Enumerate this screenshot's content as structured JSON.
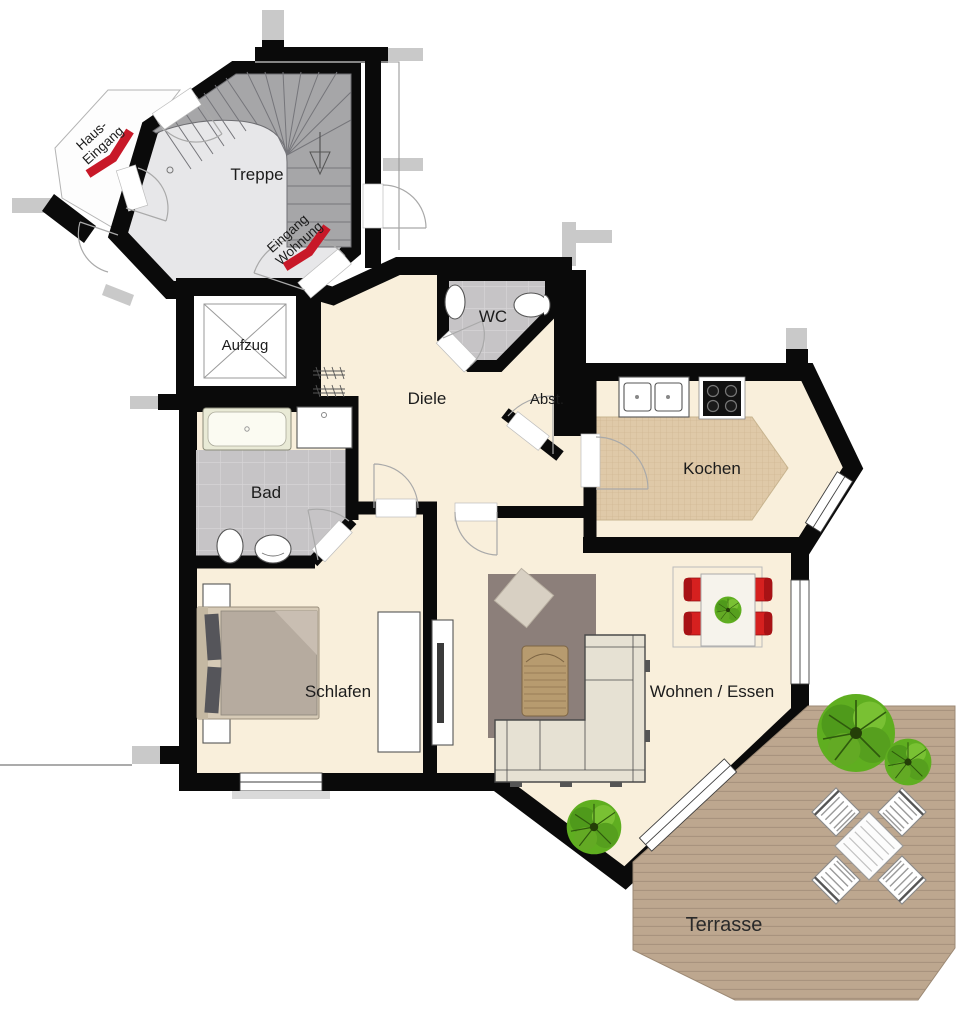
{
  "plan": {
    "rooms": {
      "treppe": "Treppe",
      "aufzug": "Aufzug",
      "diele": "Diele",
      "wc": "WC",
      "abstellraum": "Abst.",
      "kochen": "Kochen",
      "bad": "Bad",
      "schlafen": "Schlafen",
      "wohnen_essen": "Wohnen / Essen",
      "terrasse": "Terrasse"
    },
    "entrances": {
      "haus_line1": "Haus-",
      "haus_line2": "Eingang",
      "wohnung_line1": "Eingang",
      "wohnung_line2": "Wohnung"
    },
    "colors": {
      "wall": "#0a0a0a",
      "floor": "#f9efdb",
      "stair_floor": "#e7e7e9",
      "stair_steps": "#a6a6a8",
      "tile_gray": "#c6c4c6",
      "tile_line": "#d6d4d6",
      "kitchen_tile": "#dfc9a8",
      "terrace_deck": "#bda78f",
      "terrace_line": "#a8937e",
      "rug": "#8c7f7a",
      "sofa": "#e6e1d3",
      "accent_red": "#c81828",
      "chair_red": "#d6201f",
      "plant_green": "#5fae20",
      "bed_duvet": "#b6ab9f",
      "bed_frame": "#d6cab6",
      "wood": "#b79b6f"
    }
  }
}
